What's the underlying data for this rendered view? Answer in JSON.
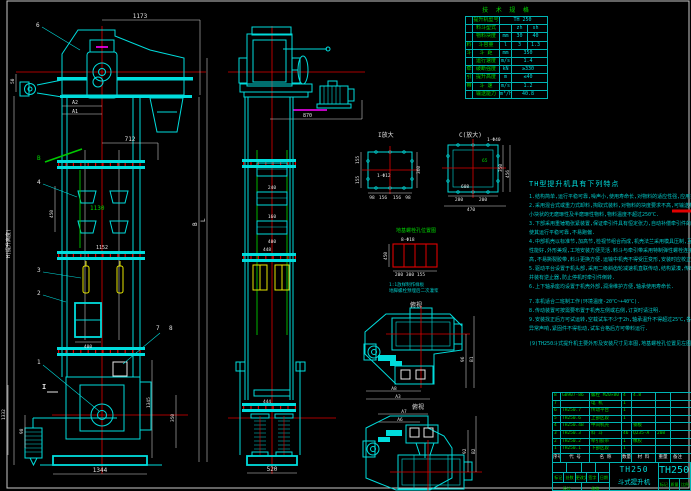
{
  "front": {
    "dim_1173": "1173",
    "label_6": "6",
    "dim_50": "50",
    "dim_a2": "A2",
    "dim_a1": "A1",
    "label_b": "B",
    "dim_712": "712",
    "label_4": "4",
    "dim_450": "450",
    "dim_1130": "1130",
    "dim_1152": "1152",
    "label_3": "3",
    "label_2": "2",
    "height_note": "H(提升高度)",
    "dim_400": "400",
    "label_7": "7",
    "label_8": "8",
    "label_1": "1",
    "label_i": "I",
    "dim_1344": "1344",
    "dim_1345": "1345",
    "dim_350": "350",
    "dim_1332": "1332",
    "dim_98": "98",
    "letter_b": "B",
    "letter_l": "L"
  },
  "side": {
    "dim_870": "870",
    "dim_240": "240",
    "dim_160": "160",
    "dim_400": "400",
    "dim_448": "448",
    "dim_444": "444",
    "dim_520": "520"
  },
  "spec": {
    "title": "技 术 规 格",
    "rows": [
      {
        "g": "",
        "label": "提升机型号",
        "unit": "",
        "v": "TH 250"
      },
      {
        "g": "",
        "label": "料斗型式",
        "unit": "",
        "v": "zh",
        "v2": "sh"
      },
      {
        "g": "",
        "label": "物料块度",
        "unit": "mm",
        "v": "30",
        "v2": "40"
      },
      {
        "g": "料",
        "label": "斗容量",
        "unit": "l",
        "v": "3",
        "v2": "1.3"
      },
      {
        "g": "斗",
        "label": "斗 距",
        "unit": "mm",
        "v": "350"
      },
      {
        "g": "",
        "label": "运行速度",
        "unit": "m/s",
        "v": "1.4"
      },
      {
        "g": "牵",
        "label": "破断强度",
        "unit": "kN",
        "v": "≥330"
      },
      {
        "g": "引",
        "label": "提升高度",
        "unit": "m",
        "v": "≤40"
      },
      {
        "g": "带",
        "label": "斗 速",
        "unit": "m/s",
        "v": "1.2"
      },
      {
        "g": "",
        "label": "输送能力",
        "unit": "m³/h",
        "v": "40.8"
      }
    ]
  },
  "detail_i": {
    "title": "I放大",
    "hole": "1-Φ12",
    "left1": "155",
    "left2": "155",
    "right": "360",
    "b1": "98",
    "b2": "156",
    "b3": "156",
    "b4": "98"
  },
  "detail_c": {
    "title": "C(放大)",
    "hole": "1-Φ40",
    "inner": "608",
    "green": "65",
    "b1": "280",
    "b2": "200",
    "total": "470",
    "r1": "350",
    "r2": "456"
  },
  "anchor": {
    "title": "地基螺栓孔位置图",
    "hole": "8-Φ18",
    "left": "450",
    "b1": "200",
    "b2": "300",
    "b3": "155",
    "note1": "1:1放样制作样板",
    "note2": "地脚螺栓预埋后二次灌浆"
  },
  "drive1": {
    "label": "俯视",
    "a8": "A8",
    "a3": "A3",
    "r1": "96",
    "r2": "B1"
  },
  "drive2": {
    "label": "俯视",
    "a7": "A7",
    "a6": "A6",
    "r1": "92",
    "r2": "B2"
  },
  "notes": {
    "title": "TH型提升机具有下列特点",
    "highlight": "(见技术规格表)",
    "lines": [
      "1.结构简单,运行平稳可靠,噪声小,使用寿命长,对物料的适应性强,应用范围广.",
      "2.采用混合式或重力式卸料,掏取式装料,对物料的块度要求不高,可输送粉状,粒状及",
      "小块状的无磨琢性及半磨琢性物料,物料温度不超过250℃.",
      "3.下部采用重锤箱张紧装置,保证牵引件具有恒定张力,自动补偿牵引件的永久伸长,",
      "使其运行平稳可靠,不易跑偏.",
      "4.中部机壳以标准节,加高节,检视节组合而成,机壳法兰采用模具压制,互换性好,密封",
      "性能好,外形美观,工地安装方便灵活.料斗与牵引带采用特制弹性螺栓连接,连接强度",
      "高,不易撕裂胶带,料斗更换方便.运输中机壳不得受压变形,安装时应校正垂直度.",
      "5.驱动平台设置于机头部,采用二级斜齿轮减速机直联传动,结构紧凑,传动效率高",
      "并装有逆止器,防止停机时牵引件倒转.",
      "6.上下轴承座均设置于机壳外部,润滑维护方便,轴承使用寿命长.",
      "7.本机适合二班制工作(环境温度-20℃~+40℃).",
      "8.传动装置可按需要布置于机壳左侧或右侧,订货时请注明.",
      "9.安装找正后方可试运转,空载试车不少于2h,轴承温升不得超过25℃,各部位不得有",
      "异常声响,紧固件不得松动,试车合格后方可带料运行.",
      "(9)TH250斗式提升机主要外形及安装尺寸见本图,地基螺栓孔位置见左图所示 供参."
    ]
  },
  "bom": {
    "header": [
      "序号",
      "代 号",
      "名 称",
      "数量",
      "材 料",
      "重量",
      "备注"
    ],
    "rows": [
      [
        "8",
        "GB907-86",
        "螺栓 M20×80",
        "4",
        "4.8",
        "",
        ""
      ],
      [
        "7",
        "",
        "电 机",
        "1",
        "",
        "",
        ""
      ],
      [
        "6",
        "TH250.7",
        "传动平台",
        "1",
        "",
        "",
        ""
      ],
      [
        "5",
        "TH250.6",
        "上部区段",
        "1",
        "",
        "",
        ""
      ],
      [
        "4",
        "TH250.4B",
        "中间机壳",
        "",
        "钢板",
        "",
        ""
      ],
      [
        "3",
        "TH250.3",
        "料 斗",
        "46",
        "Q235-A",
        "208",
        ""
      ],
      [
        "2",
        "TH250.2",
        "牵引胶带",
        "1",
        "橡胶",
        "",
        ""
      ],
      [
        "1",
        "TH250.1",
        "下部区段",
        "1",
        "",
        "",
        ""
      ]
    ]
  },
  "titleblock": {
    "model": "TH250",
    "name": "斗式提升机",
    "drawing_no": "TH250",
    "sig1": "标记",
    "sig2": "处数",
    "sig3": "更改文件号",
    "sig4": "签字",
    "sig5": "日期",
    "left1": "设计",
    "left2": "校核",
    "r1": "标记",
    "r2": "质量",
    "r3": "比例"
  }
}
